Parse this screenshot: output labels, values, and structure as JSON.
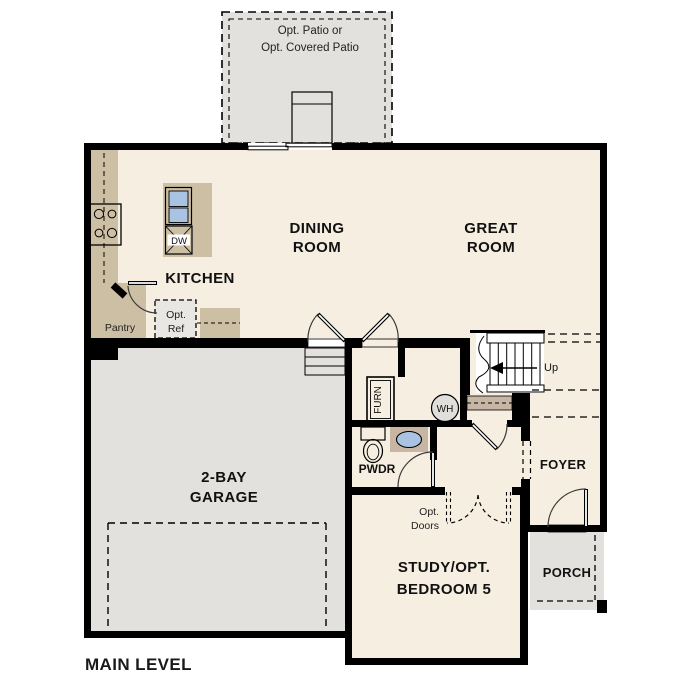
{
  "plan": {
    "title": "MAIN LEVEL",
    "colors": {
      "floor": "#f6eee0",
      "exterior_concrete": "#e2e1de",
      "counter": "#cdbfa4",
      "cabinet_dark": "#c6b6a3",
      "sink_blue": "#a9c3e2",
      "optional_box": "#e9e7e3",
      "wall": "#000000",
      "wh_fill": "#e1dfdb"
    },
    "labels": {
      "patio1": "Opt. Patio or",
      "patio2": "Opt. Covered Patio",
      "dining1": "DINING",
      "dining2": "ROOM",
      "great1": "GREAT",
      "great2": "ROOM",
      "kitchen": "KITCHEN",
      "pantry": "Pantry",
      "opt_ref1": "Opt.",
      "opt_ref2": "Ref",
      "dishwasher": "DW",
      "garage1": "2-BAY",
      "garage2": "GARAGE",
      "furnace": "FURN",
      "water_heater": "WH",
      "stairs_up": "Up",
      "pwdr": "PWDR",
      "foyer": "FOYER",
      "porch": "PORCH",
      "study1": "STUDY/OPT.",
      "study2": "BEDROOM 5",
      "opt_doors1": "Opt.",
      "opt_doors2": "Doors"
    }
  }
}
